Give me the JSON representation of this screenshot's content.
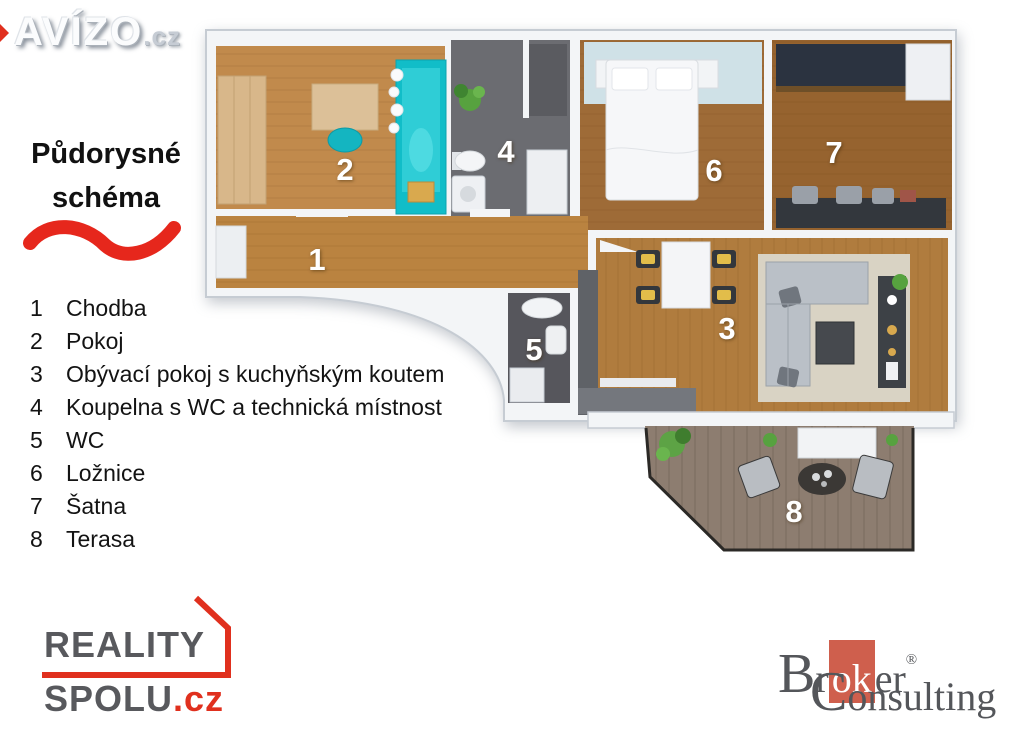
{
  "watermark": {
    "brand": "AVÍZO",
    "tld": ".cz"
  },
  "panel": {
    "title_line1": "Půdorysné",
    "title_line2": "schéma"
  },
  "legend": {
    "items": [
      {
        "num": "1",
        "label": "Chodba"
      },
      {
        "num": "2",
        "label": "Pokoj"
      },
      {
        "num": "3",
        "label": "Obývací pokoj s kuchyňským koutem"
      },
      {
        "num": "4",
        "label": "Koupelna s WC a technická místnost"
      },
      {
        "num": "5",
        "label": "WC"
      },
      {
        "num": "6",
        "label": "Ložnice"
      },
      {
        "num": "7",
        "label": "Šatna"
      },
      {
        "num": "8",
        "label": "Terasa"
      }
    ]
  },
  "floorplan": {
    "labels": {
      "r1": "1",
      "r2": "2",
      "r3": "3",
      "r4": "4",
      "r5": "5",
      "r6": "6",
      "r7": "7",
      "r8": "8"
    }
  },
  "logos": {
    "reality_spolu": {
      "line1": "REALITY",
      "line2": "SPOLU",
      "tld": ".cz"
    },
    "broker_consulting": {
      "cap1": "B",
      "seg1": "r",
      "seg_ok": "ok",
      "seg2": "er",
      "reg": "®",
      "cap2": "C",
      "seg3": "onsulting"
    }
  },
  "colors": {
    "accent_red": "#e6271c",
    "reality_red": "#e0301e",
    "reality_gray": "#58595d",
    "broker_gray": "#54565a",
    "broker_square": "#cf5f4d",
    "wood_light": "#c18a4c",
    "wood_mid": "#b07c3e",
    "wood_dark": "#9a6833",
    "tile_dark": "#6b6c71",
    "teal": "#12bdc8",
    "rug_blue": "#cfe1e7",
    "deck": "#8d7d70"
  }
}
